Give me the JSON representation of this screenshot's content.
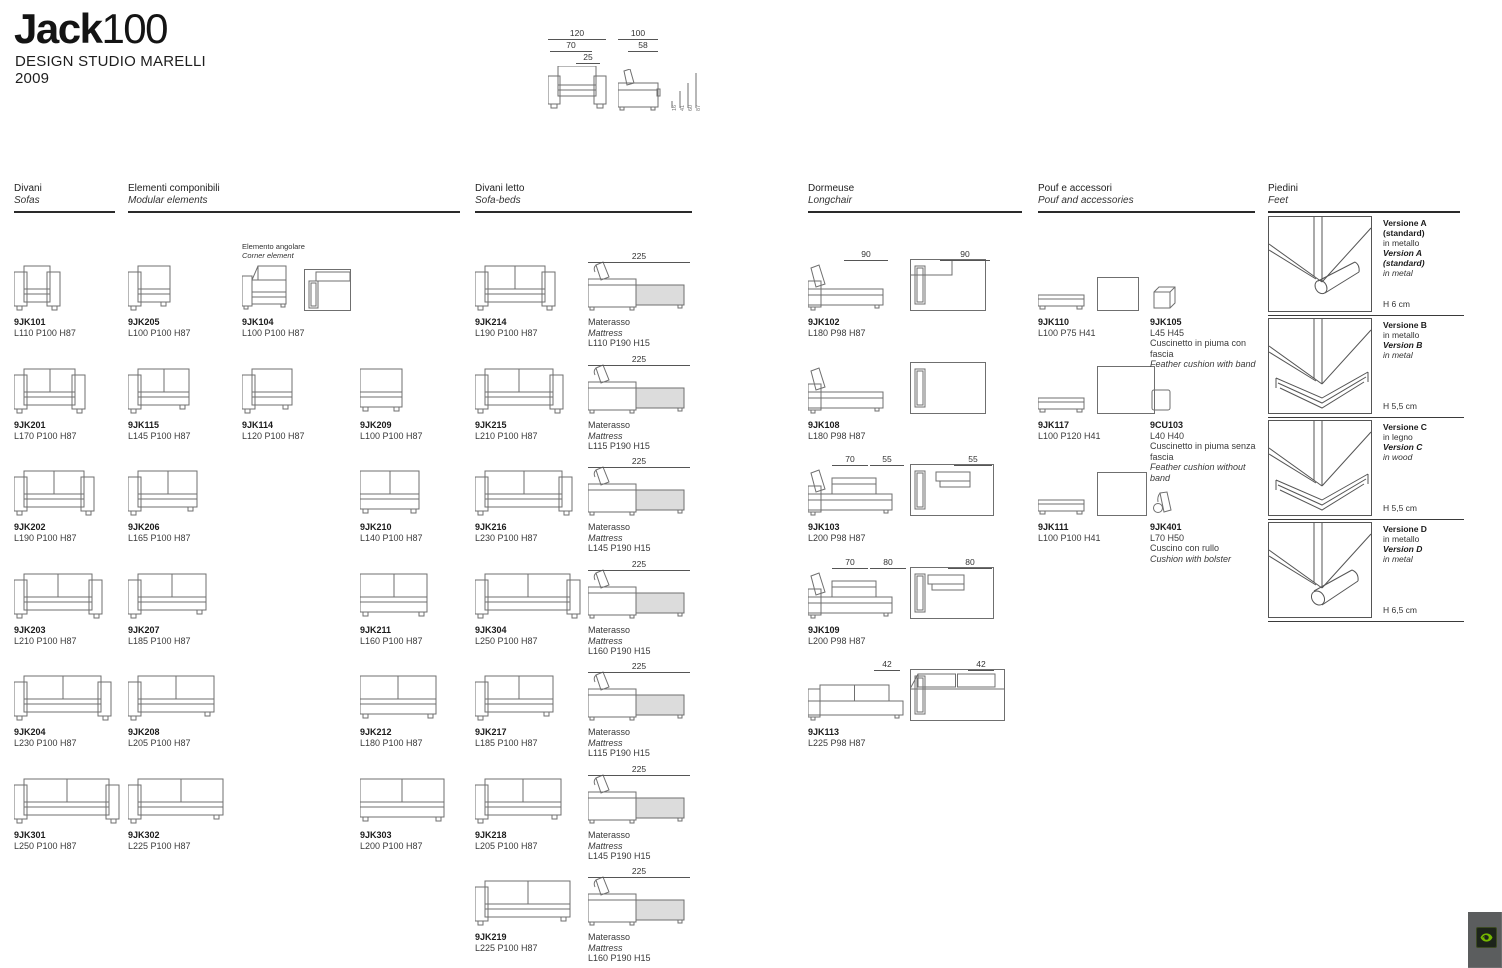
{
  "header": {
    "title_bold": "Jack",
    "title_light": "100",
    "studio": "DESIGN STUDIO MARELLI",
    "year": "2009"
  },
  "overview": {
    "front_dims": [
      {
        "t": "120",
        "x": 2,
        "w": 58,
        "y": 2
      },
      {
        "t": "70",
        "x": 4,
        "w": 42,
        "y": 14
      },
      {
        "t": "25",
        "x": 30,
        "w": 24,
        "y": 26
      }
    ],
    "side_dims": [
      {
        "t": "100",
        "x": 72,
        "w": 40,
        "y": 2
      },
      {
        "t": "58",
        "x": 82,
        "w": 30,
        "y": 14
      }
    ],
    "heights": [
      "16",
      "41",
      "60",
      "87"
    ]
  },
  "sections": [
    {
      "title_it": "Divani",
      "title_en": "Sofas"
    },
    {
      "title_it": "Elementi componibili",
      "title_en": "Modular elements"
    },
    {
      "title_it": "Divani letto",
      "title_en": "Sofa-beds"
    },
    {
      "title_it": "Dormeuse",
      "title_en": "Longchair"
    },
    {
      "title_it": "Pouf e accessori",
      "title_en": "Pouf and accessories"
    },
    {
      "title_it": "Piedini",
      "title_en": "Feet"
    }
  ],
  "corner_note": {
    "it": "Elemento angolare",
    "en": "Corner element"
  },
  "mattress_label": {
    "it": "Materasso",
    "en": "Mattress"
  },
  "divani": [
    {
      "code": "9JK101",
      "dims": "L110 P100 H87",
      "L": 110,
      "arms": "both",
      "cushions": 1
    },
    {
      "code": "9JK201",
      "dims": "L170 P100 H87",
      "L": 170,
      "arms": "both",
      "cushions": 2
    },
    {
      "code": "9JK202",
      "dims": "L190 P100 H87",
      "L": 190,
      "arms": "both",
      "cushions": 2
    },
    {
      "code": "9JK203",
      "dims": "L210 P100 H87",
      "L": 210,
      "arms": "both",
      "cushions": 2
    },
    {
      "code": "9JK204",
      "dims": "L230 P100 H87",
      "L": 230,
      "arms": "both",
      "cushions": 2
    },
    {
      "code": "9JK301",
      "dims": "L250 P100 H87",
      "L": 250,
      "arms": "both",
      "cushions": 2
    }
  ],
  "componibili_a": [
    {
      "code": "9JK205",
      "dims": "L100 P100 H87",
      "L": 100,
      "arms": "left",
      "cushions": 1
    },
    {
      "code": "9JK115",
      "dims": "L145 P100 H87",
      "L": 145,
      "arms": "left",
      "cushions": 2
    },
    {
      "code": "9JK206",
      "dims": "L165 P100 H87",
      "L": 165,
      "arms": "left",
      "cushions": 2
    },
    {
      "code": "9JK207",
      "dims": "L185 P100 H87",
      "L": 185,
      "arms": "left",
      "cushions": 2
    },
    {
      "code": "9JK208",
      "dims": "L205 P100 H87",
      "L": 205,
      "arms": "left",
      "cushions": 2
    },
    {
      "code": "9JK302",
      "dims": "L225 P100 H87",
      "L": 225,
      "arms": "left",
      "cushions": 2
    }
  ],
  "componibili_b": [
    {
      "code": "9JK104",
      "dims": "L100 P100 H87",
      "art": "corner",
      "row": 0
    },
    {
      "code": "9JK114",
      "dims": "L120 P100 H87",
      "L": 120,
      "arms": "left",
      "cushions": 1,
      "row": 1
    }
  ],
  "componibili_c": [
    {
      "code": "9JK209",
      "dims": "L100 P100 H87",
      "L": 100,
      "arms": "none",
      "cushions": 1,
      "row": 1
    },
    {
      "code": "9JK210",
      "dims": "L140 P100 H87",
      "L": 140,
      "arms": "none",
      "cushions": 2,
      "row": 2
    },
    {
      "code": "9JK211",
      "dims": "L160 P100 H87",
      "L": 160,
      "arms": "none",
      "cushions": 2,
      "row": 3
    },
    {
      "code": "9JK212",
      "dims": "L180 P100 H87",
      "L": 180,
      "arms": "none",
      "cushions": 2,
      "row": 4
    },
    {
      "code": "9JK303",
      "dims": "L200 P100 H87",
      "L": 200,
      "arms": "none",
      "cushions": 2,
      "row": 5
    }
  ],
  "divani_letto": [
    {
      "code": "9JK214",
      "dims": "L190 P100 H87",
      "L": 190,
      "arms": "both",
      "cushions": 2,
      "mattress": "L110 P190 H15",
      "span": "225"
    },
    {
      "code": "9JK215",
      "dims": "L210 P100 H87",
      "L": 210,
      "arms": "both",
      "cushions": 2,
      "mattress": "L115 P190 H15",
      "span": "225"
    },
    {
      "code": "9JK216",
      "dims": "L230 P100 H87",
      "L": 230,
      "arms": "both",
      "cushions": 2,
      "mattress": "L145 P190 H15",
      "span": "225"
    },
    {
      "code": "9JK304",
      "dims": "L250 P100 H87",
      "L": 250,
      "arms": "both",
      "cushions": 2,
      "mattress": "L160 P190 H15",
      "span": "225"
    },
    {
      "code": "9JK217",
      "dims": "L185 P100 H87",
      "L": 185,
      "arms": "left",
      "cushions": 2,
      "mattress": "L115 P190 H15",
      "span": "225"
    },
    {
      "code": "9JK218",
      "dims": "L205 P100 H87",
      "L": 205,
      "arms": "left",
      "cushions": 2,
      "mattress": "L145 P190 H15",
      "span": "225"
    },
    {
      "code": "9JK219",
      "dims": "L225 P100 H87",
      "L": 225,
      "arms": "left",
      "cushions": 2,
      "mattress": "L160 P190 H15",
      "span": "225"
    }
  ],
  "dormeuse": [
    {
      "code": "9JK102",
      "dims": "L180 P98 H87",
      "L": 180,
      "side": "plain",
      "top": "bandleft",
      "ann": [
        {
          "t": "90",
          "x": 36,
          "w": 44
        },
        {
          "t": "90",
          "x": 132,
          "w": 50
        }
      ]
    },
    {
      "code": "9JK108",
      "dims": "L180 P98 H87",
      "L": 180,
      "side": "plain",
      "top": "plain",
      "ann": []
    },
    {
      "code": "9JK103",
      "dims": "L200 P98 H87",
      "L": 200,
      "side": "cushion",
      "top": "cushion",
      "ann": [
        {
          "t": "70",
          "x": 24,
          "w": 36
        },
        {
          "t": "55",
          "x": 62,
          "w": 34
        },
        {
          "t": "55",
          "x": 146,
          "w": 38
        }
      ]
    },
    {
      "code": "9JK109",
      "dims": "L200 P98 H87",
      "L": 200,
      "side": "cushion",
      "top": "cushion2",
      "ann": [
        {
          "t": "70",
          "x": 24,
          "w": 36
        },
        {
          "t": "80",
          "x": 62,
          "w": 36
        },
        {
          "t": "80",
          "x": 140,
          "w": 44
        }
      ]
    },
    {
      "code": "9JK113",
      "dims": "L225 P98 H87",
      "L": 225,
      "side": "sofa",
      "top": "sofa",
      "ann": [
        {
          "t": "42",
          "x": 66,
          "w": 26
        },
        {
          "t": "42",
          "x": 160,
          "w": 26
        }
      ]
    }
  ],
  "pouf_main": [
    {
      "code": "9JK110",
      "dims": "L100 P75 H41",
      "tw": 42,
      "th": 34
    },
    {
      "code": "9JK117",
      "dims": "L100 P120 H41",
      "tw": 58,
      "th": 48
    },
    {
      "code": "9JK111",
      "dims": "L100 P100 H41",
      "tw": 50,
      "th": 44
    }
  ],
  "pouf_acc": [
    {
      "code": "9JK105",
      "dims": "L45 H45",
      "note_it": "Cuscinetto in piuma con fascia",
      "note_en": "Feather cushion with band",
      "art": "cube"
    },
    {
      "code": "9CU103",
      "dims": "L40 H40",
      "note_it": "Cuscinetto in piuma senza fascia",
      "note_en": "Feather cushion without band",
      "art": "square"
    },
    {
      "code": "9JK401",
      "dims": "L70 H50",
      "note_it": "Cuscino con rullo",
      "note_en": "Cushion with bolster",
      "art": "bolster"
    }
  ],
  "feet": [
    {
      "line1": "Versione A (standard)",
      "line2": "in metallo",
      "line3": "Version A (standard)",
      "line4": "in metal",
      "height": "H 6 cm",
      "foot": "cylinder"
    },
    {
      "line1": "Versione B",
      "line2": "in metallo",
      "line3": "Version B",
      "line4": "in metal",
      "height": "H 5,5 cm",
      "foot": "bars"
    },
    {
      "line1": "Versione C",
      "line2": "in legno",
      "line3": "Version C",
      "line4": "in wood",
      "height": "H 5,5 cm",
      "foot": "bars"
    },
    {
      "line1": "Versione D",
      "line2": "in metallo",
      "line3": "Version D",
      "line4": "in metal",
      "height": "H 6,5 cm",
      "foot": "cylinder2"
    }
  ],
  "colors": {
    "ink": "#222222",
    "stroke": "#6f6f6f",
    "mattress_fill": "#dcdcdc",
    "overlay_bg": "#5b5d5e",
    "nvidia_green": "#76b900"
  }
}
